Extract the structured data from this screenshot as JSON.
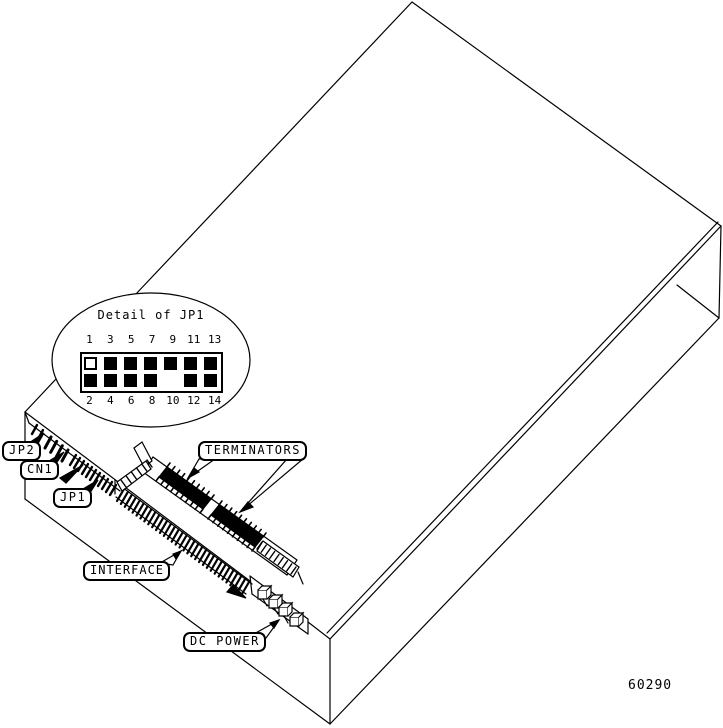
{
  "figure": {
    "number": "60290"
  },
  "detail_inset": {
    "title": "Detail of JP1",
    "top_pin_labels": [
      "1",
      "3",
      "5",
      "7",
      "9",
      "11",
      "13"
    ],
    "bottom_pin_labels": [
      "2",
      "4",
      "6",
      "8",
      "10",
      "12",
      "14"
    ],
    "top_pin_states": [
      "open",
      "filled",
      "filled",
      "filled",
      "filled",
      "filled",
      "filled"
    ],
    "bottom_pin_states": [
      "filled",
      "filled",
      "filled",
      "filled",
      "absent",
      "filled",
      "filled"
    ]
  },
  "callouts": {
    "jp2": "JP2",
    "cn1": "CN1",
    "jp1": "JP1",
    "terminators": "TERMINATORS",
    "interface": "INTERFACE",
    "dc_power": "DC POWER"
  },
  "colors": {
    "line": "#000000",
    "background": "#ffffff"
  }
}
